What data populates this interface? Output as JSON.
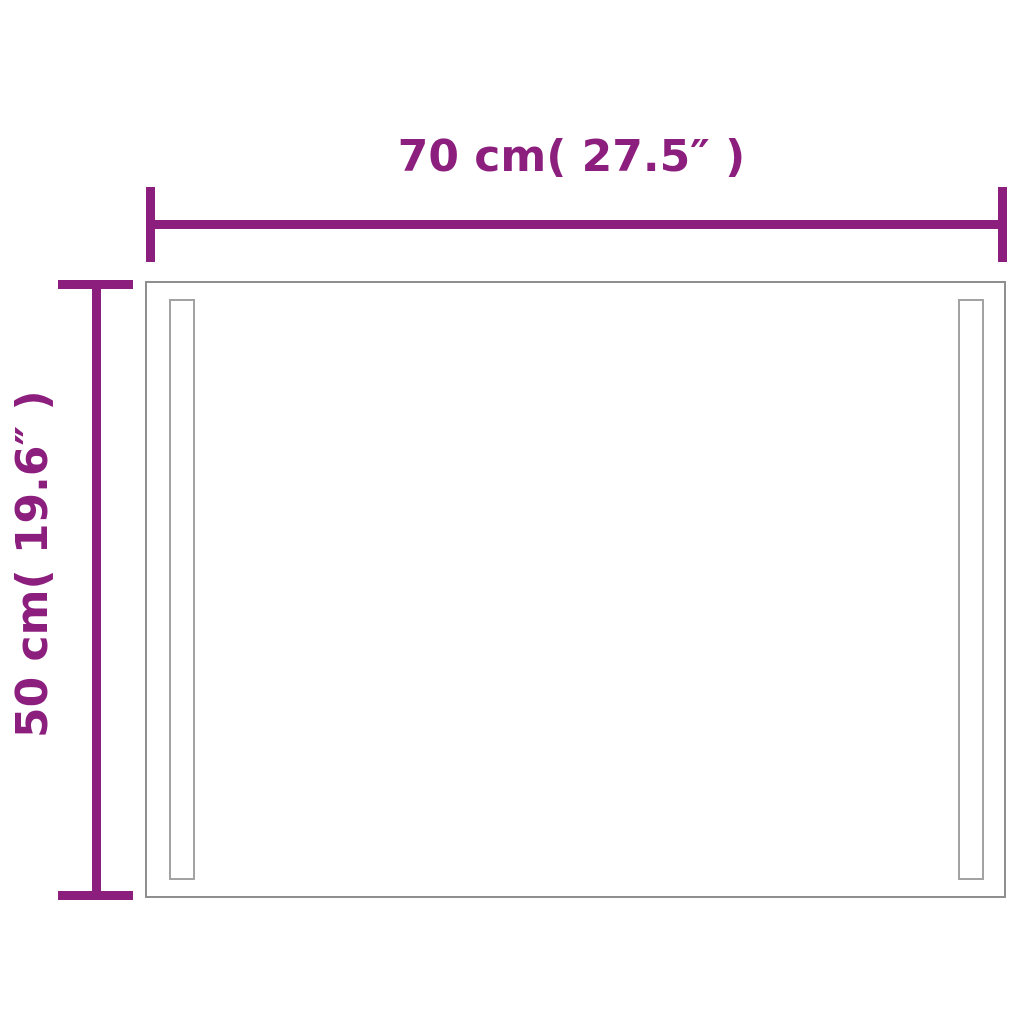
{
  "diagram": {
    "kind": "product-dimension-diagram",
    "product_shape": "rectangular mirror with two vertical led strips"
  },
  "dimensions": {
    "width": {
      "label": "70 cm( 27.5″ )",
      "value_cm": 70,
      "value_inches": 27.5
    },
    "height": {
      "label": "50 cm( 19.6″ )",
      "value_cm": 50,
      "value_inches": 19.6
    }
  },
  "colors": {
    "dimension_accent": "#8C1E7E",
    "outline_gray": "#8F8F8F",
    "strip_outline": "#A3A3A3",
    "background": "#FFFFFF"
  }
}
